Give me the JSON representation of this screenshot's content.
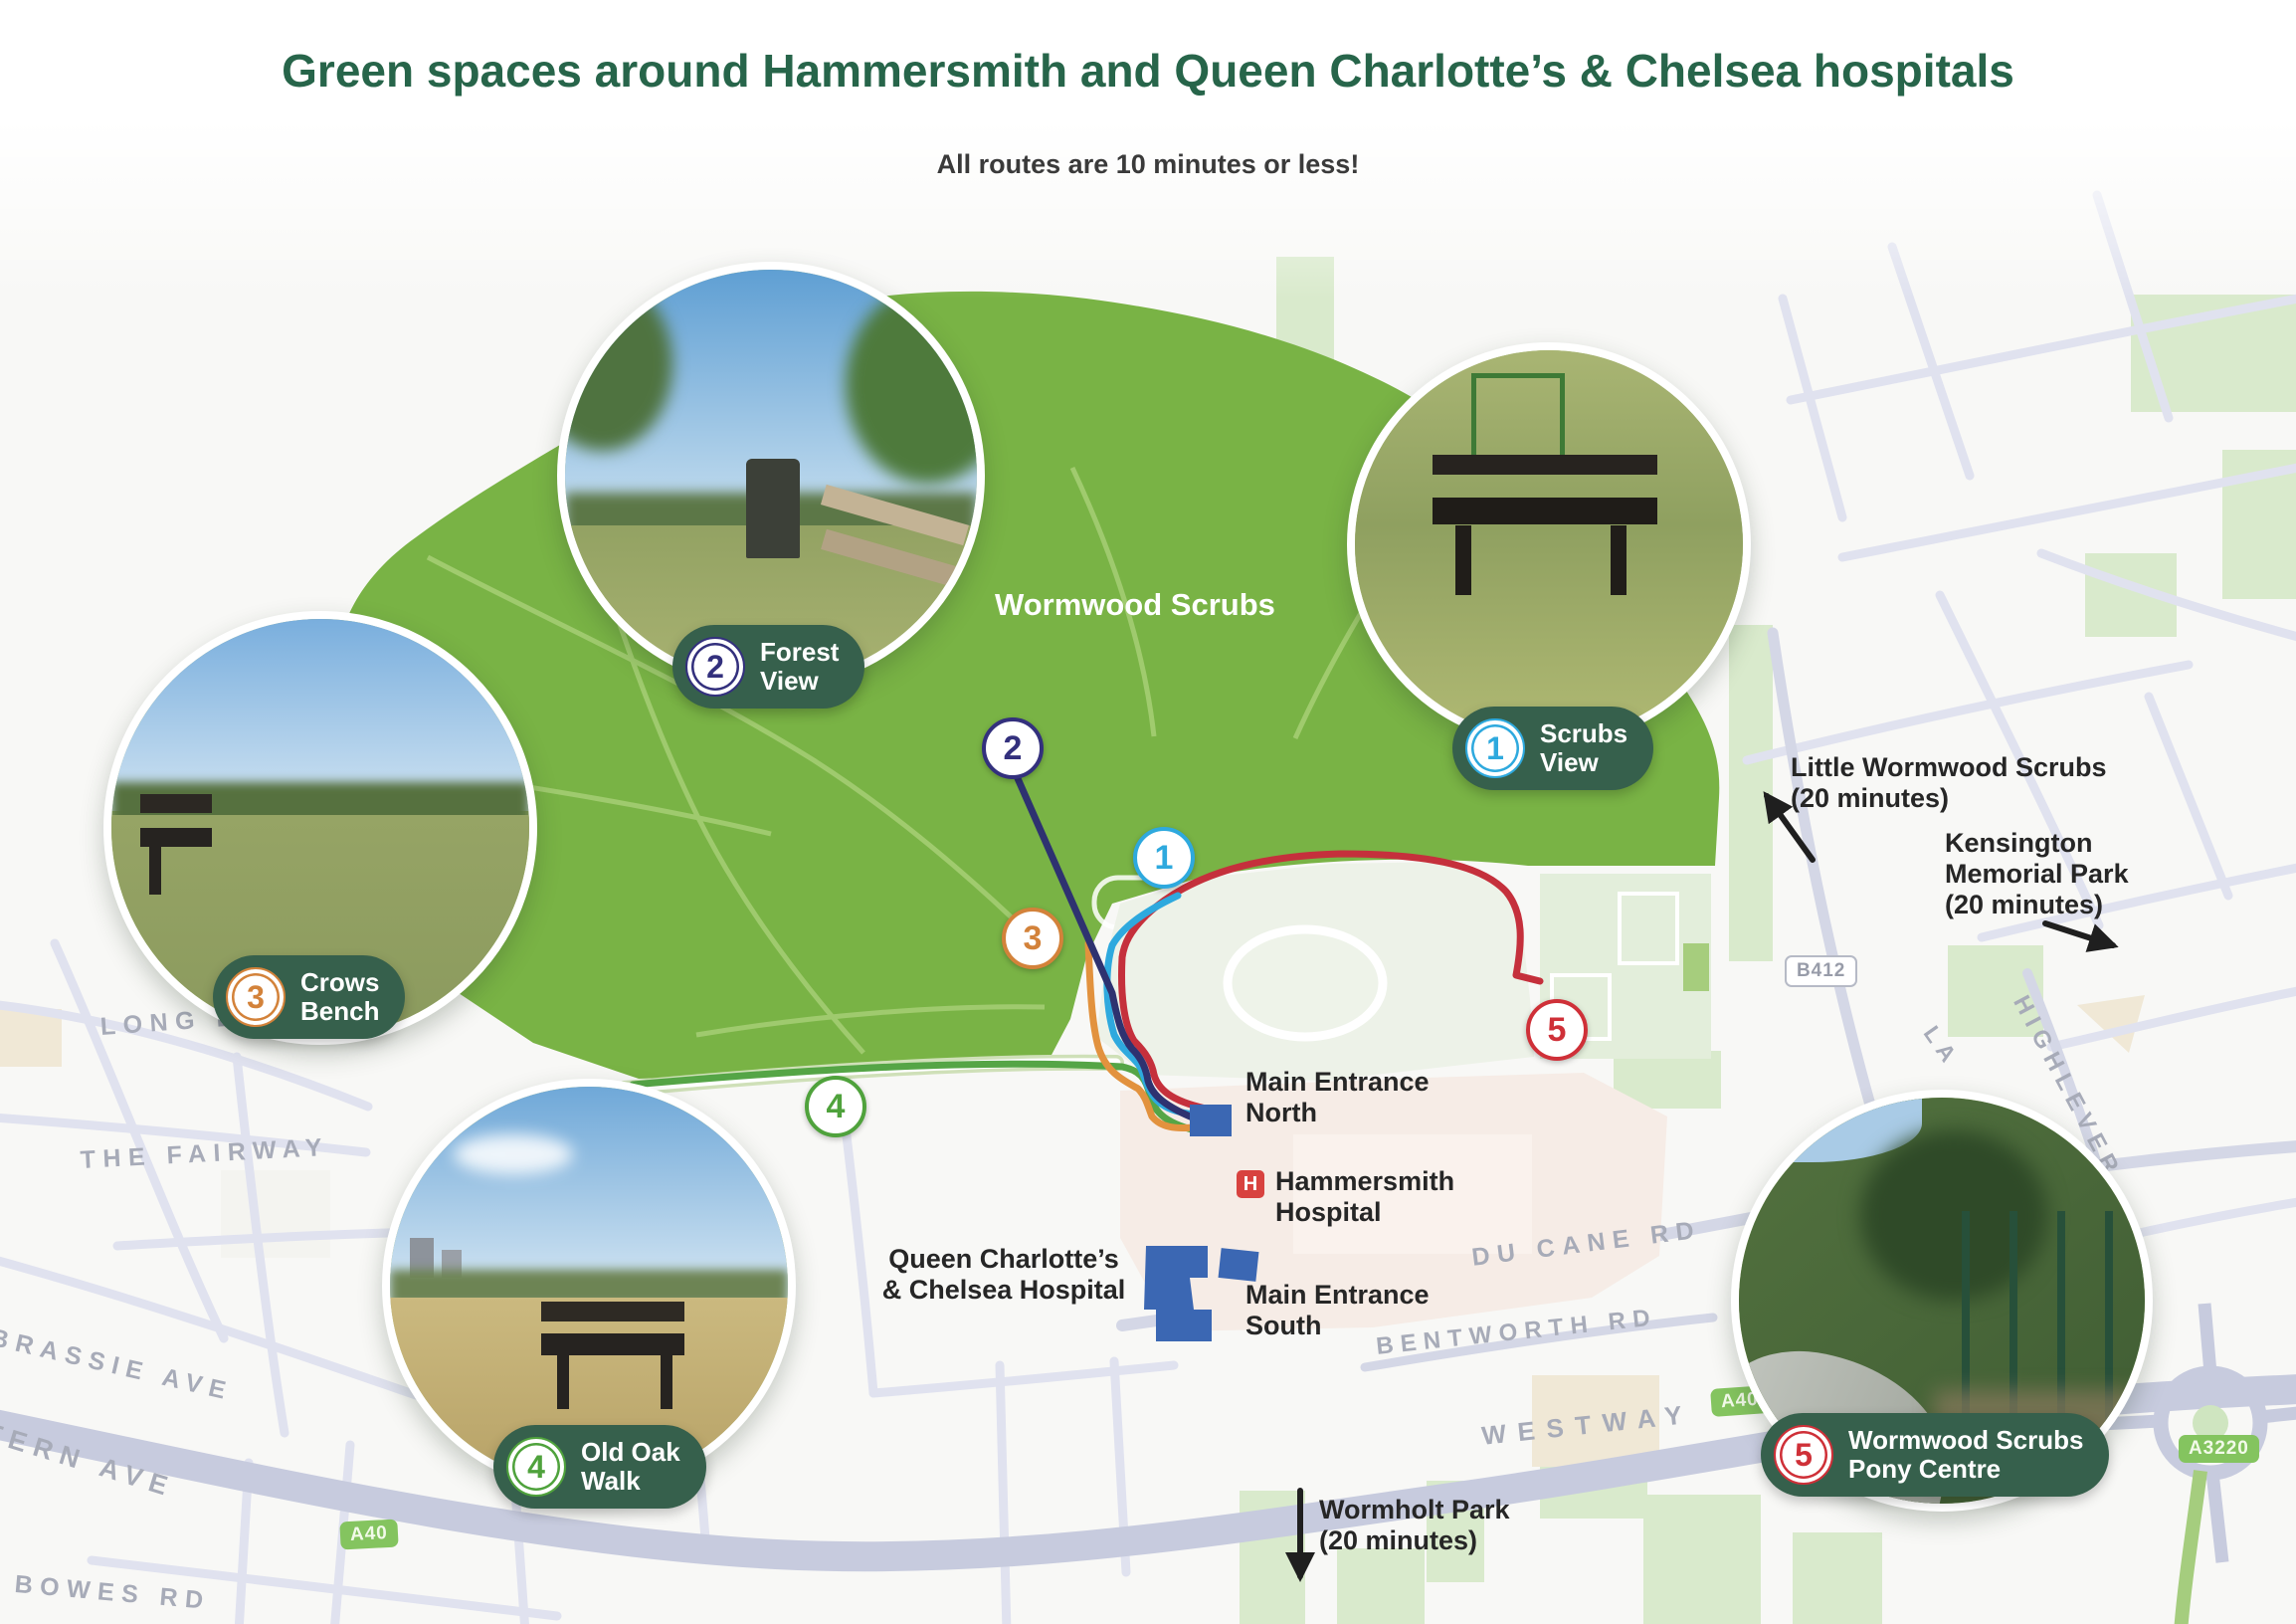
{
  "header": {
    "title": "Green spaces around Hammersmith and Queen Charlotte’s & Chelsea hospitals",
    "subtitle": "All routes are 10 minutes or less!"
  },
  "map": {
    "park_label": "Wormwood Scrubs",
    "locations": [
      {
        "num": "1",
        "name": "Scrubs\nView",
        "color": "#2ea9de"
      },
      {
        "num": "2",
        "name": "Forest\nView",
        "color": "#33307d"
      },
      {
        "num": "3",
        "name": "Crows\nBench",
        "color": "#d3823a"
      },
      {
        "num": "4",
        "name": "Old Oak\nWalk",
        "color": "#4fa23c"
      },
      {
        "num": "5",
        "name": "Wormwood Scrubs\nPony Centre",
        "color": "#cf3038"
      }
    ],
    "hospital": {
      "symbol": "H",
      "hammersmith": "Hammersmith\nHospital",
      "queen_charlottes": "Queen Charlotte’s\n& Chelsea Hospital",
      "main_entrance_north": "Main Entrance\nNorth",
      "main_entrance_south": "Main Entrance\nSouth"
    },
    "nearby": [
      {
        "name": "Little Wormwood Scrubs\n(20 minutes)"
      },
      {
        "name": "Kensington Memorial Park\n(20 minutes)"
      },
      {
        "name": "Wormholt Park\n(20 minutes)"
      }
    ],
    "road_labels": [
      "LONG D",
      "THE FAIRWAY",
      "BRASSIE AVE",
      "TERN AVE",
      "BOWES RD",
      "DU CANE RD",
      "BENTWORTH RD",
      "WESTWAY",
      "HIGHLEVER",
      "LA"
    ],
    "road_badges": [
      "B412",
      "A40",
      "A40",
      "A3220"
    ]
  },
  "colors": {
    "title_green": "#27654a",
    "pill_green": "#36604c",
    "park_green": "#79b345",
    "route_red": "#c5303c",
    "route_cyan": "#2ea9de",
    "route_navy": "#2e3270",
    "route_orange": "#e2923e",
    "route_green": "#55a546",
    "hospital_red": "#d8423f",
    "building_blue": "#3b67b3"
  }
}
